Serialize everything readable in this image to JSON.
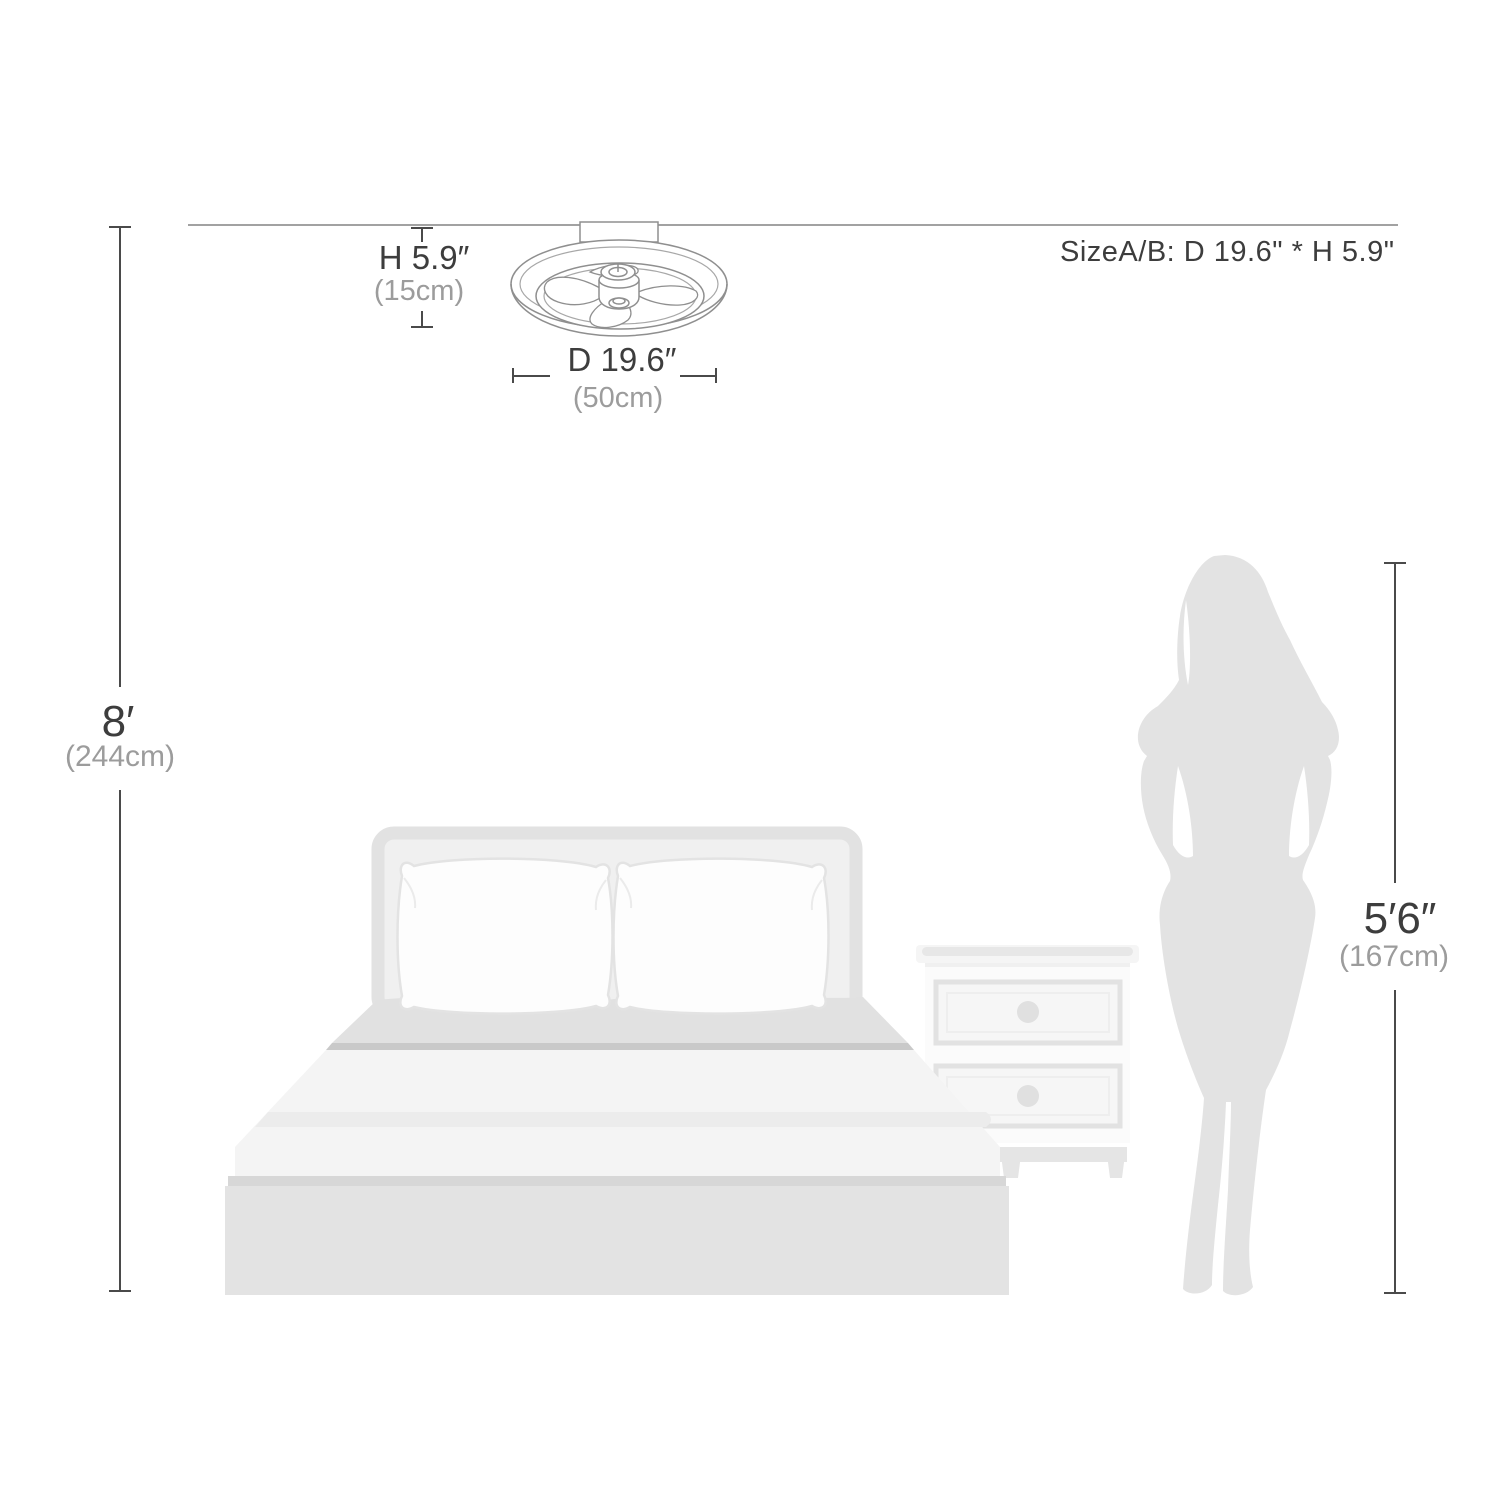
{
  "annotations": {
    "fan_height": {
      "value": "H 5.9″",
      "metric": "(15cm)"
    },
    "fan_diameter": {
      "value": "D 19.6″",
      "metric": "(50cm)"
    },
    "size_note": "SizeA/B: D 19.6\" * H 5.9\"",
    "ceiling_height": {
      "value": "8′",
      "metric": "(244cm)"
    },
    "person_height": {
      "value": "5′6″",
      "metric": "(167cm)"
    }
  },
  "colors": {
    "text_primary": "#3d3d3d",
    "text_secondary": "#9c9c9c",
    "dimension_line": "#4a4a4a",
    "ceiling_line": "#a2a2a2",
    "fan_outline": "#8f8f8f",
    "furniture_light": "#f4f4f4",
    "furniture_mid": "#e3e3e3",
    "furniture_dark": "#c9c9c9",
    "silhouette": "#e3e3e3"
  },
  "scene": {
    "objects": [
      {
        "name": "ceiling-fan",
        "type": "line-drawing"
      },
      {
        "name": "bed",
        "type": "illustration"
      },
      {
        "name": "nightstand",
        "type": "illustration"
      },
      {
        "name": "woman-silhouette",
        "type": "illustration"
      }
    ]
  }
}
